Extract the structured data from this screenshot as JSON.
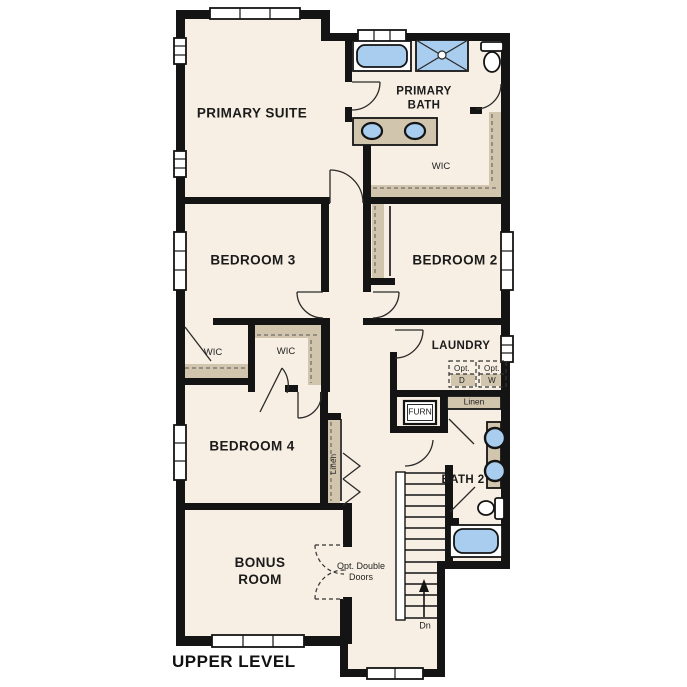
{
  "title": "UPPER LEVEL",
  "colors": {
    "floor": "#f7efe3",
    "wall": "#141414",
    "tan": "#d2c5ae",
    "blue": "#a9cdee"
  },
  "rooms": {
    "primary_suite": "PRIMARY SUITE",
    "primary_bath": "PRIMARY BATH",
    "primary_wic": "WIC",
    "bedroom_2": "BEDROOM 2",
    "bedroom_3": "BEDROOM 3",
    "bedroom_4": "BEDROOM 4",
    "laundry": "LAUNDRY",
    "bath_2": "BATH 2",
    "bonus_room": "BONUS ROOM",
    "wic_left": "WIC",
    "wic_right": "WIC"
  },
  "annotations": {
    "opt_dryer_top": "Opt.",
    "opt_dryer_bottom": "D",
    "opt_washer_top": "Opt.",
    "opt_washer_bottom": "W",
    "linen_hall": "Linen",
    "linen_closet": "Linen",
    "furnace": "FURN",
    "stairs_direction": "Dn",
    "optional_double_doors": "Opt. Double Doors"
  }
}
